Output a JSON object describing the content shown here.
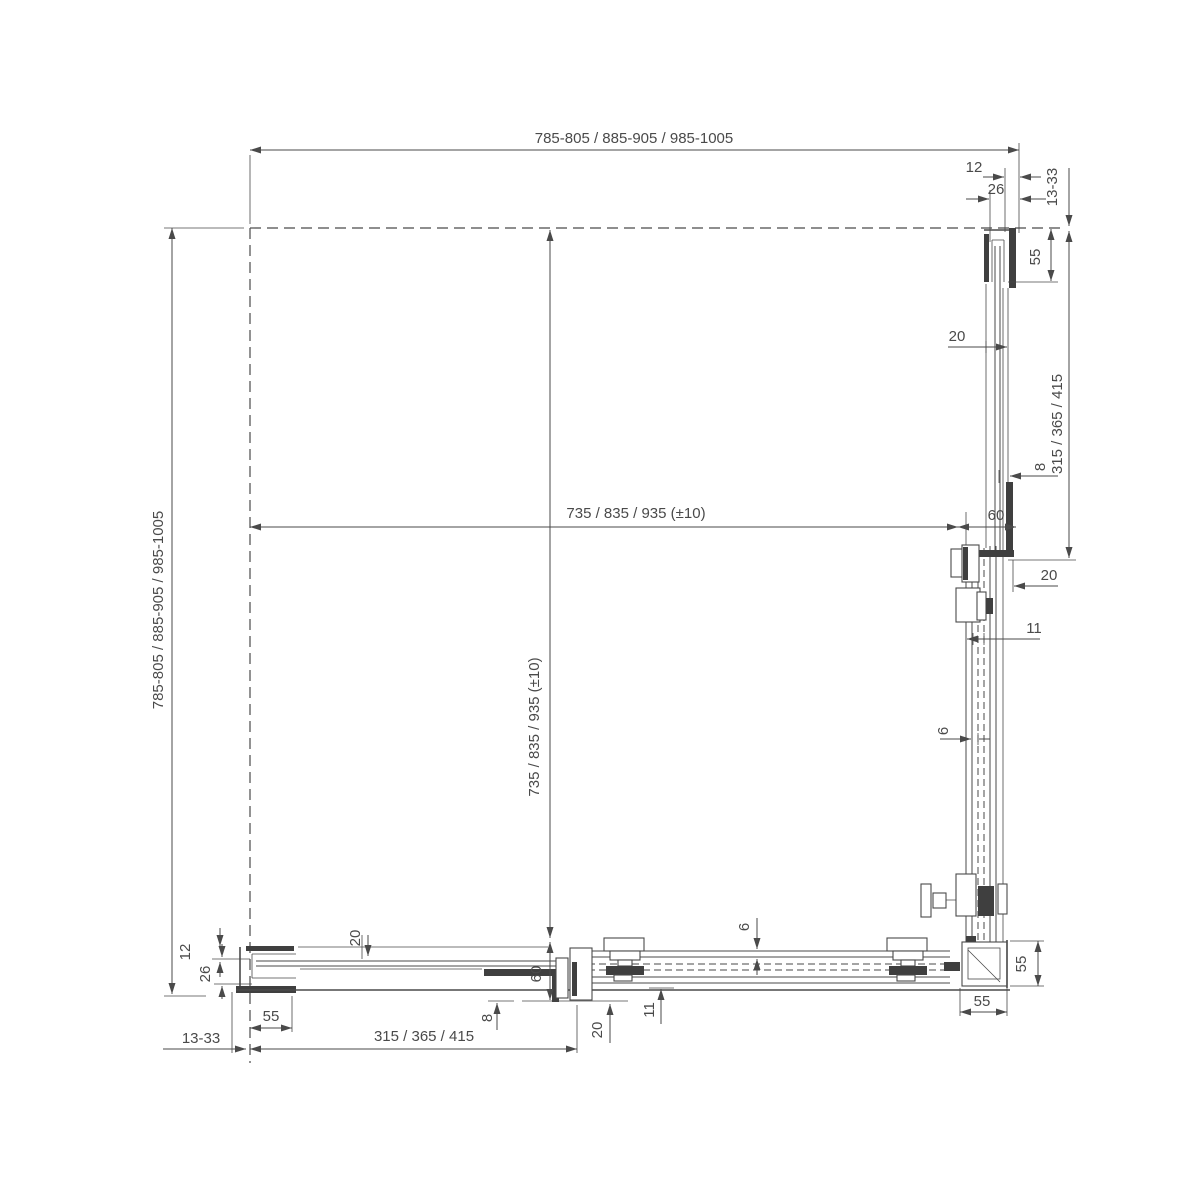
{
  "drawing": {
    "description": "Corner sliding shower enclosure installation plan drawing (top view) with fixed panels, sliding doors, wall profiles and corner post",
    "background": "#ffffff",
    "line_color": "#4a4a4a",
    "dims": {
      "overall_width": "785-805 / 885-905 / 985-1005",
      "overall_depth": "785-805 / 885-905 / 985-1005",
      "inner_width": "735 / 835 / 935 (±10)",
      "inner_depth": "735 / 835 / 935 (±10)",
      "right": {
        "w12": "12",
        "w26": "26",
        "adj": "13-33",
        "p55": "55",
        "g20": "20",
        "fixed_len": "315 / 365 / 415",
        "g8": "8",
        "d60": "60",
        "d20": "20",
        "d11": "11",
        "d6": "6"
      },
      "bottom": {
        "w12": "12",
        "w26": "26",
        "adj": "13-33",
        "p55": "55",
        "g20": "20",
        "fixed_len": "315 / 365 / 415",
        "g8": "8",
        "d60": "60",
        "d20": "20",
        "d11": "11",
        "d6": "6"
      },
      "corner": {
        "v55": "55",
        "h55": "55"
      }
    }
  }
}
